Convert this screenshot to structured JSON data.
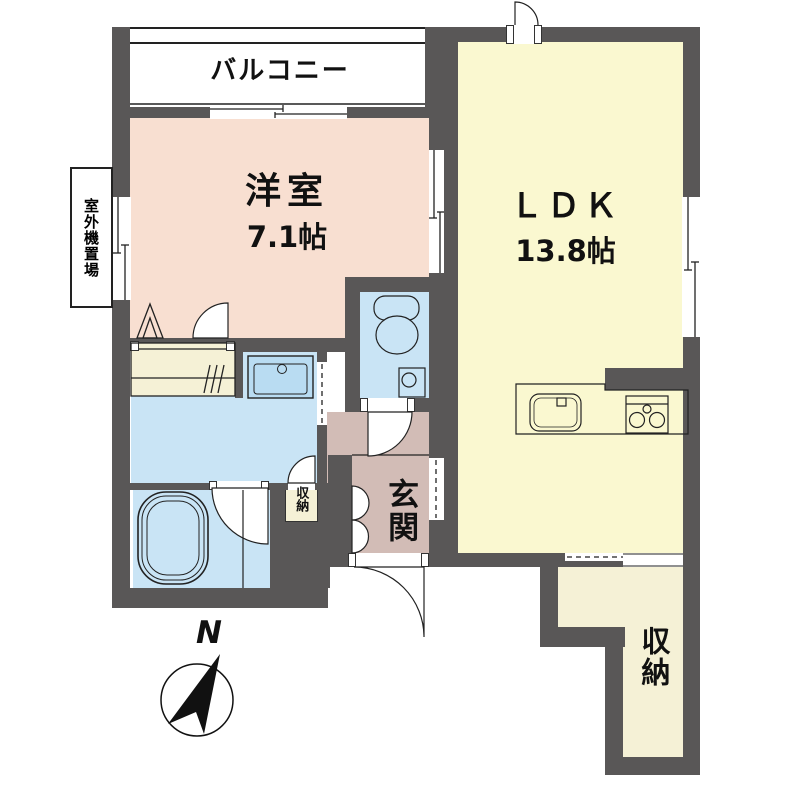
{
  "plan": {
    "compass_label": "N",
    "balcony": {
      "label": "バルコニー"
    },
    "western_room": {
      "label": "洋室",
      "size": "7.1帖",
      "area_tatami": 7.1
    },
    "ldk": {
      "label": "ＬＤＫ",
      "size": "13.8帖",
      "area_tatami": 13.8
    },
    "entrance": {
      "label": "玄関"
    },
    "hall_storage": {
      "label": "収納"
    },
    "main_storage": {
      "label": "収納"
    },
    "outdoor_unit": {
      "label": "室外機置場"
    },
    "colors": {
      "wall": "#595757",
      "western_room": "#F8DFD1",
      "ldk": "#FAF8D0",
      "wet_area": "#C9E4F5",
      "entrance_hall": "#D2BCB6",
      "storage": "#F5F1D6",
      "fixture_blue": "#B9DCF2",
      "line": "#222222"
    }
  }
}
